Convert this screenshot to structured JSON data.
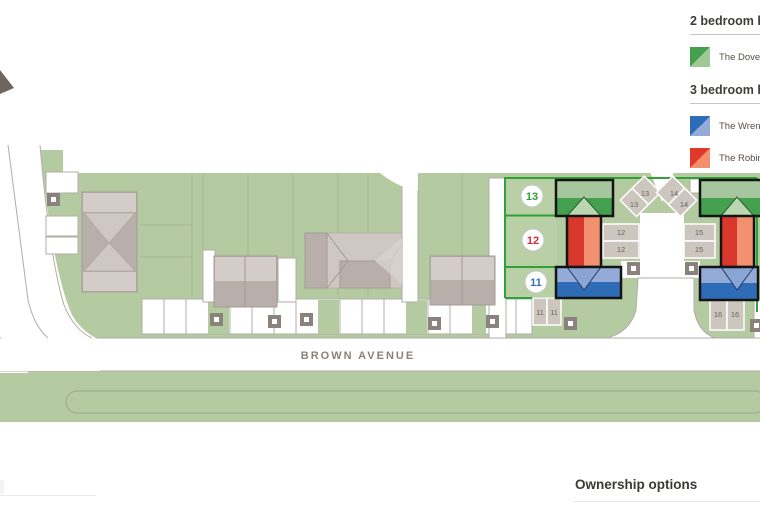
{
  "legend": {
    "sections": [
      {
        "title": "2 bedroom homes",
        "items": [
          {
            "name": "The Dove",
            "color_dark": "#44a04e",
            "color_light": "#9fc897"
          }
        ]
      },
      {
        "title": "3 bedroom homes",
        "items": [
          {
            "name": "The Wren",
            "color_dark": "#2e6cb8",
            "color_light": "#92abd7"
          },
          {
            "name": "The Robin",
            "color_dark": "#e0392c",
            "color_light": "#f2906e"
          }
        ]
      }
    ]
  },
  "site": {
    "road_name": "BROWN AVENUE",
    "plots": [
      {
        "number": "13",
        "house_type": "The Dove",
        "number_color": "#2fa136"
      },
      {
        "number": "12",
        "house_type": "The Robin",
        "number_color": "#cc2f36"
      },
      {
        "number": "11",
        "house_type": "The Wren",
        "number_color": "#3a6cc0"
      }
    ],
    "parking": {
      "p13": [
        "13",
        "13"
      ],
      "p14": [
        "14",
        "14"
      ],
      "p12": [
        "12",
        "12"
      ],
      "p15": [
        "15",
        "15"
      ],
      "p11": [
        "11",
        "11"
      ],
      "p16": [
        "16",
        "16"
      ]
    },
    "colors": {
      "field_green": "#b4caa1",
      "plot_boundary_green": "#2fa136",
      "parking_gray": "#cdc6bf",
      "building_gray": "#b8afab",
      "road_edge": "#b2aca6",
      "house_outline": "#141414"
    }
  },
  "footer": {
    "heading": "Ownership options"
  }
}
